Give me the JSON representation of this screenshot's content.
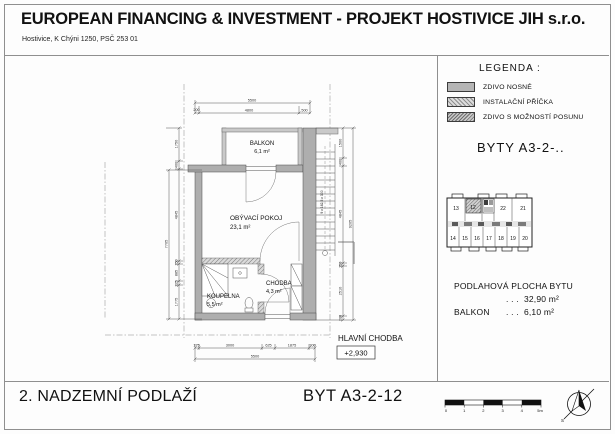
{
  "header": {
    "title": "EUROPEAN FINANCING & INVESTMENT - PROJEKT HOSTIVICE JIH s.r.o.",
    "address": "Hostivice, K Chýni 1250, PSČ 253 01"
  },
  "legend": {
    "heading": "LEGENDA :",
    "items": [
      {
        "label": "ZDIVO NOSNÉ",
        "swatch": "solid-gray"
      },
      {
        "label": "INSTALAČNÍ PŘÍČKA",
        "swatch": "diagonal-hatch"
      },
      {
        "label": "ZDIVO S MOŽNOSTÍ POSUNU",
        "swatch": "dense-hatch"
      }
    ]
  },
  "byty_heading": "BYTY  A3-2-..",
  "key_plan": {
    "top_units": [
      "13",
      "12",
      "22",
      "21"
    ],
    "bottom_units": [
      "14",
      "15",
      "16",
      "17",
      "18",
      "19",
      "20"
    ],
    "highlighted_unit": "12"
  },
  "areas": {
    "rows": [
      {
        "label": "PODLAHOVÁ PLOCHA BYTU",
        "dots": ". . .",
        "value": "32,90 m²"
      },
      {
        "label": "BALKON",
        "dots": ". . .",
        "value": "6,10 m²"
      }
    ]
  },
  "plan": {
    "rooms": {
      "balkon": {
        "name": "BALKON",
        "area": "6,1 m²"
      },
      "obyvaci": {
        "name": "OBÝVACÍ POKOJ",
        "area": "23,1 m²"
      },
      "chodba": {
        "name": "CHODBA",
        "area": "4,3 m²"
      },
      "koupelna": {
        "name": "KOUPELNA",
        "area": "5,5 m²"
      }
    },
    "main_corridor": "HLAVNÍ CHODBA",
    "elevation": "+2,930",
    "stair_note": "9 x 162,5 x 300",
    "dims": {
      "top_overall": "5500",
      "top_segments": [
        "200",
        "4800",
        "500"
      ],
      "bottom_overall": "5500",
      "bottom_segments": [
        "175",
        "3000",
        "625",
        "1875",
        "300"
      ],
      "left_overall": "7705",
      "left_segments": [
        "1750",
        "400",
        "4845",
        "150",
        "885",
        "225",
        "1775"
      ],
      "right_overall": "9205",
      "right_segments": [
        "1500",
        "400",
        "4845",
        "150",
        "2510",
        "200"
      ]
    }
  },
  "footer": {
    "floor_title": "2. NADZEMNÍ PODLAŽÍ",
    "unit_title": "BYT  A3-2-12",
    "scale_ticks": [
      "0",
      "1",
      "2",
      "3",
      "4",
      "5m"
    ],
    "north_label": "S"
  }
}
